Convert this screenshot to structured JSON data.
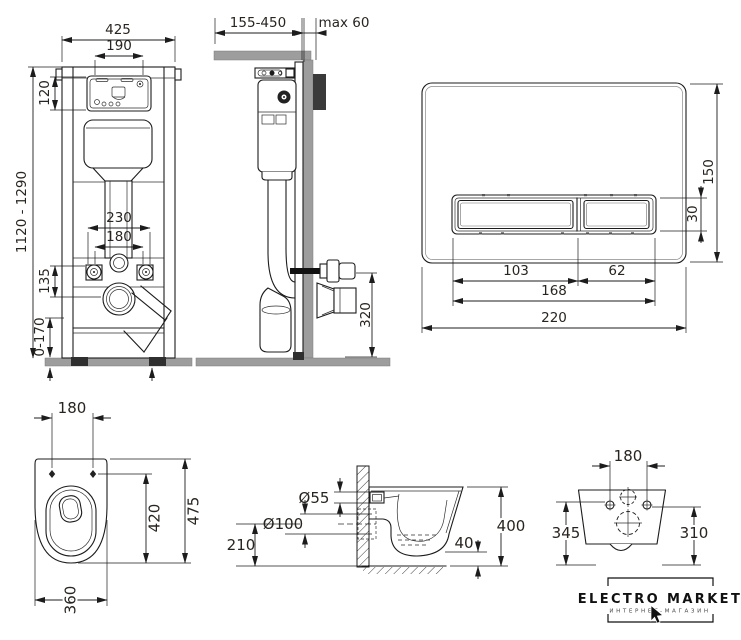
{
  "drawing": {
    "frame_front": {
      "width_total": "425",
      "access_width": "190",
      "access_height": "120",
      "frame_height": "1120 - 1290",
      "fixing_span": "230",
      "bolt_span": "180",
      "outlet_drop": "135",
      "foot_adjust": "0-170"
    },
    "frame_side": {
      "depth_adjust": "155-450",
      "wall_max": "max 60",
      "connect_height": "320"
    },
    "flush_plate": {
      "plate_height": "150",
      "button_height": "30",
      "big_button_width": "103",
      "small_button_width": "62",
      "buttons_width": "168",
      "plate_width": "220"
    },
    "pan_top": {
      "bolt_span": "180",
      "depth_total": "475",
      "depth_inner": "420",
      "width": "360"
    },
    "pan_side": {
      "inlet_dia": "Ø55",
      "outlet_dia": "Ø100",
      "outlet_height": "210",
      "pan_height": "400",
      "gap": "40"
    },
    "pan_rear": {
      "bolt_span": "180",
      "height_left": "345",
      "height_right": "310"
    },
    "brand": {
      "name": "ELECTRO MARKET",
      "tagline": "ИНТЕРНЕТ-МАГАЗИН"
    },
    "colors": {
      "line": "#1c1c1c",
      "masonry": "#9d9d9d",
      "insulation": "#3a3a3a",
      "text": "#29241f"
    }
  }
}
